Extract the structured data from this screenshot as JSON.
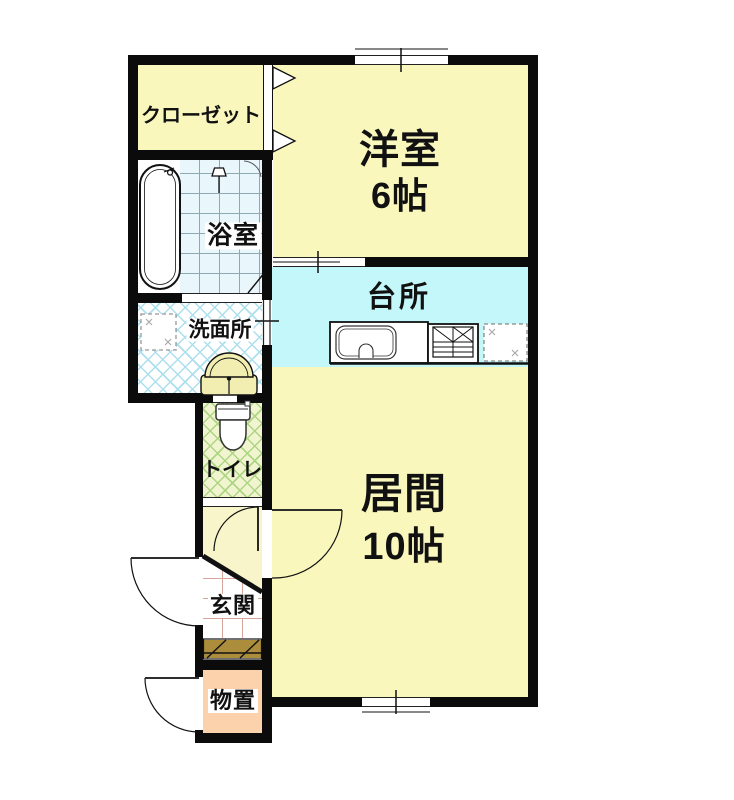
{
  "colors": {
    "wall": "#0b0b0b",
    "room_yellow": "#faf7bd",
    "hall_yellow": "#f7f5c9",
    "kitchen_cyan": "#c3f7f9",
    "bath_tile_bg": "#e9f6fb",
    "bath_tile_line": "#8fa9b3",
    "wash_bg": "#ffffff",
    "wash_line": "#ace0ed",
    "toilet_bg": "#f0f4cf",
    "toilet_line": "#aed584",
    "genkan_tile_line": "#d8a59b",
    "step_brown": "#ab8d3c",
    "storage_salmon": "#fbd2ab",
    "fixture_cream": "#f2eeb2"
  },
  "rooms": {
    "closet": {
      "label": "クローゼット"
    },
    "western_room": {
      "label": "洋室",
      "size": "6帖"
    },
    "bathroom": {
      "label": "浴室"
    },
    "washroom": {
      "label": "洗面所"
    },
    "kitchen": {
      "label": "台所"
    },
    "toilet": {
      "label": "トイレ"
    },
    "living_room": {
      "label": "居間",
      "size": "10帖"
    },
    "entrance": {
      "label": "玄関"
    },
    "storage": {
      "label": "物置"
    }
  },
  "icons": [
    "bathtub",
    "shower-head",
    "bathroom-folding-door",
    "washing-machine-space",
    "washbasin",
    "toilet-seat",
    "kitchen-sink",
    "gas-stove",
    "refrigerator-space",
    "closet-bifold-door",
    "door-swing-arc",
    "window-tick"
  ]
}
